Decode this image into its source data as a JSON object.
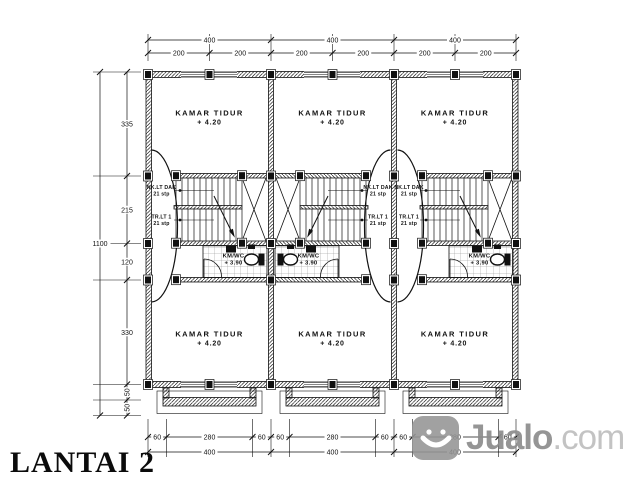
{
  "title": "LANTAI 2",
  "watermark": {
    "icon": "smiley-icon",
    "brand": "Jualo",
    "suffix": ".com"
  },
  "rooms": {
    "bedrooms": [
      {
        "name": "KAMAR TIDUR",
        "level": "+ 4.20"
      },
      {
        "name": "KAMAR TIDUR",
        "level": "+ 4.20"
      },
      {
        "name": "KAMAR TIDUR",
        "level": "+ 4.20"
      },
      {
        "name": "KAMAR TIDUR",
        "level": "+ 4.20"
      },
      {
        "name": "KAMAR TIDUR",
        "level": "+ 4.20"
      },
      {
        "name": "KAMAR TIDUR",
        "level": "+ 4.20"
      }
    ],
    "bathrooms": [
      {
        "name": "KM/WC",
        "level": "+ 3.90"
      },
      {
        "name": "KM/WC",
        "level": "+ 3.90"
      },
      {
        "name": "KM/WC",
        "level": "+ 3.90"
      }
    ],
    "stairs": [
      {
        "up_label": "NK.LT DAK",
        "up_steps": "21 stp",
        "down_label": "TR.LT 1",
        "down_steps": "21 stp"
      },
      {
        "up_label": "NK.LT DAK",
        "up_steps": "21 stp",
        "down_label": "TR.LT 1",
        "down_steps": "21 stp"
      },
      {
        "up_label": "NK.LT DAK",
        "up_steps": "21 stp",
        "down_label": "TR.LT 1",
        "down_steps": "21 stp"
      }
    ]
  },
  "dimensions": {
    "top_totals": [
      "400",
      "400",
      "400"
    ],
    "top_subs": [
      "200",
      "200",
      "200",
      "200",
      "200",
      "200"
    ],
    "left_total": "1100",
    "left_subs": [
      "335",
      "215",
      "120",
      "330",
      "50",
      "50"
    ],
    "bottom_subs": [
      "60",
      "280",
      "60",
      "60",
      "280",
      "60",
      "60",
      "280",
      "60"
    ],
    "bottom_totals": [
      "400",
      "400",
      "400"
    ]
  }
}
